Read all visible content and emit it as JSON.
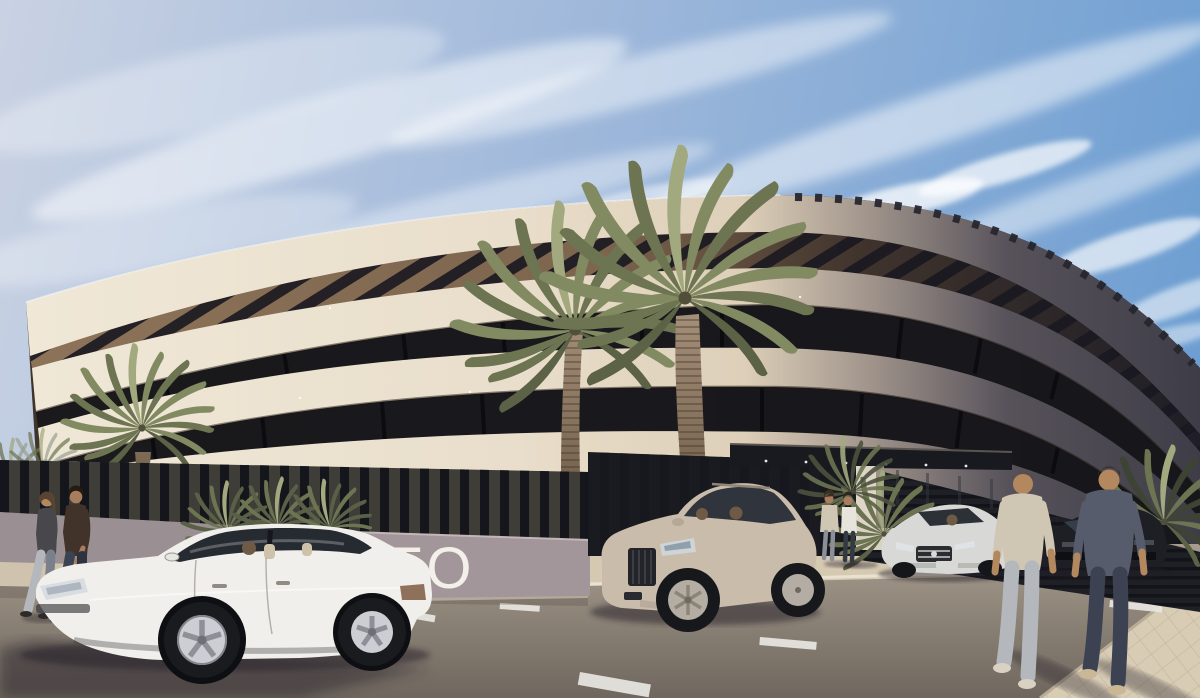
{
  "scene": {
    "type": "architectural exterior rendering",
    "setting": "Sunny daytime street view of a curved modern apartment building with cream balcony bands, dark recessed glazing and rooftop pergola slats; dark slatted perimeter fence, palm trees, parked cars and pedestrians",
    "time_of_day": "day",
    "weather": "clear with wispy cirrus clouds"
  },
  "signage": {
    "text": "TO",
    "note": "partial white lettering on mauve street wall, left part hidden behind white sedan"
  },
  "colors": {
    "sky_top_left": "#c9d2e3",
    "sky_mid": "#9db7da",
    "sky_right": "#6f9fd2",
    "cloud_white": "#ffffff",
    "facade_cream": "#f0e8d8",
    "facade_shadow": "#3e3d47",
    "soffit_tan": "#8d7459",
    "recess_dark": "#17171b",
    "fence_dark": "#14161b",
    "wall_mauve": "#a2969a",
    "sign_white": "#f3f0ea",
    "road_top": "#a79c8e",
    "road_bottom": "#6f675e",
    "sidewalk": "#d8ccb5",
    "canopy_dark": "#181a1f",
    "pillar_cream": "#ddd5c5",
    "palm_green": "#828a62",
    "palm_green_dark": "#6d7452",
    "palm_trunk": "#a5907a",
    "car_sedan_white": "#f0efeb",
    "car_suv_beige": "#c9bcab",
    "car_mercedes_silver": "#d8d9d6",
    "car_dark": "#1d1f24",
    "skin": "#b3885e",
    "shirt_beige": "#cfc6b4",
    "shirt_slate": "#565c6c",
    "jeans_light": "#b4b8bd",
    "jeans_dark": "#3c4252"
  },
  "objects": {
    "building": {
      "floors_visible": 3,
      "features": [
        "curved cream slab bands",
        "rooftop pergola slats",
        "dark recessed window bands",
        "entrance canopy",
        "dark louvered base"
      ]
    },
    "vehicles": [
      {
        "name": "white sedan",
        "view": "side, facing left, driver visible",
        "position": "foreground left"
      },
      {
        "name": "beige SUV",
        "view": "front three-quarter, two occupants",
        "position": "center, exiting driveway"
      },
      {
        "name": "silver sedan",
        "view": "front three-quarter, driver visible",
        "position": "right of entrance"
      },
      {
        "name": "dark sedan",
        "view": "front, partly hidden",
        "position": "far right"
      }
    ],
    "people": [
      {
        "name": "woman walking left",
        "clothes": "dark tee, grey jeans",
        "position": "far left"
      },
      {
        "name": "man walking left",
        "clothes": "brown tee, dark jeans",
        "position": "far left"
      },
      {
        "name": "person in beige jacket",
        "position": "standing at entrance"
      },
      {
        "name": "person in white shirt",
        "position": "standing at entrance"
      },
      {
        "name": "man in beige tee walking away",
        "position": "foreground right"
      },
      {
        "name": "man in slate tee walking away",
        "position": "foreground right"
      }
    ],
    "vegetation": {
      "large_palms": 2,
      "small_palm": 1,
      "palmetto_bushes": 3,
      "road_markings": "white dashes",
      "sidewalk": "beige pavers bottom right"
    }
  }
}
